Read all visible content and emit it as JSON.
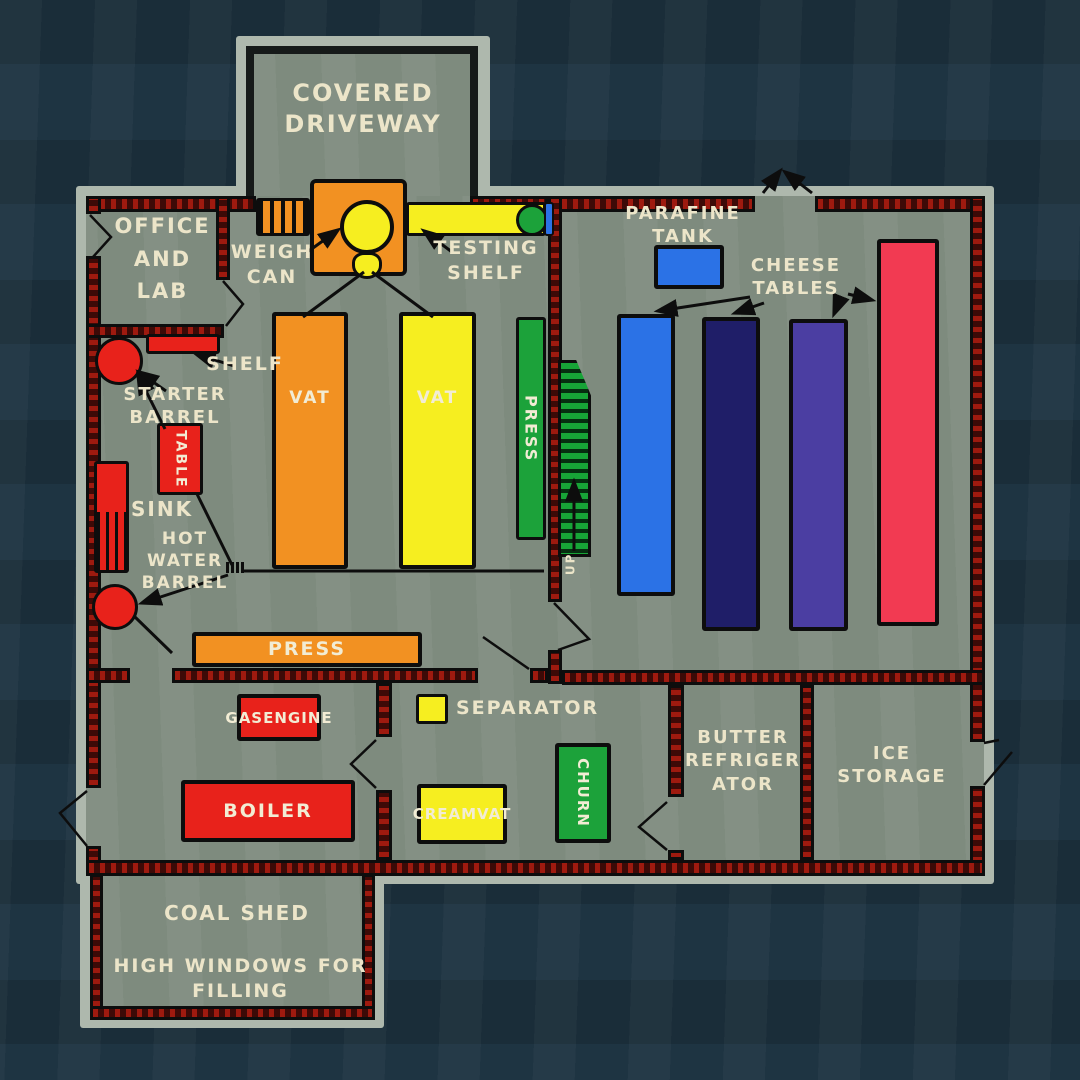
{
  "scene": "creamery-floor-plan-painting",
  "colors": {
    "background": "#1e3442",
    "floor": "#7e8b7e",
    "building_outline_halo": "#aeb8ad",
    "wall_fill": "#3d0a07",
    "wall_hatch_red": "#c32012",
    "ink_line": "#0d0d0d",
    "text_cream": "#ece5c9",
    "orange": "#f29122",
    "yellow": "#f6ee20",
    "green": "#1ca23a",
    "red": "#e8221b",
    "blue": "#2b72e6",
    "navy": "#1f1e68",
    "purple": "#4b3ea2",
    "crimson": "#f23a52"
  },
  "labels": {
    "covered_driveway": [
      "COVERED",
      "DRIVEWAY"
    ],
    "office": [
      "OFFICE",
      "AND",
      "LAB"
    ],
    "weigh_can": [
      "WEIGH",
      "CAN"
    ],
    "testing_shelf": [
      "TESTING",
      "SHELF"
    ],
    "parafine_tank": [
      "PARAFINE",
      "TANK"
    ],
    "cheese_tables": [
      "CHEESE",
      "TABLES"
    ],
    "shelf": "SHELF",
    "starter_barrel": [
      "STARTER",
      "BARREL"
    ],
    "table": "TABLE",
    "sink": "SINK",
    "hot_water_barrel": [
      "HOT",
      "WATER",
      "BARREL"
    ],
    "vat_left": "VAT",
    "vat_right": "VAT",
    "press_vertical": "PRESS",
    "stairs_up": "UP",
    "press_bar": "PRESS",
    "gas_engine": [
      "GAS",
      "ENGINE"
    ],
    "separator": "SEPARATOR",
    "boiler": "BOILER",
    "cream_vat": [
      "CREAM",
      "VAT"
    ],
    "churn": "CHURN",
    "butter_refrigerator": [
      "BUTTER",
      "REFRIGER",
      "ATOR"
    ],
    "ice_storage": [
      "ICE",
      "STORAGE"
    ],
    "coal_shed": "COAL SHED",
    "high_windows": [
      "HIGH WINDOWS FOR",
      "FILLING"
    ]
  }
}
